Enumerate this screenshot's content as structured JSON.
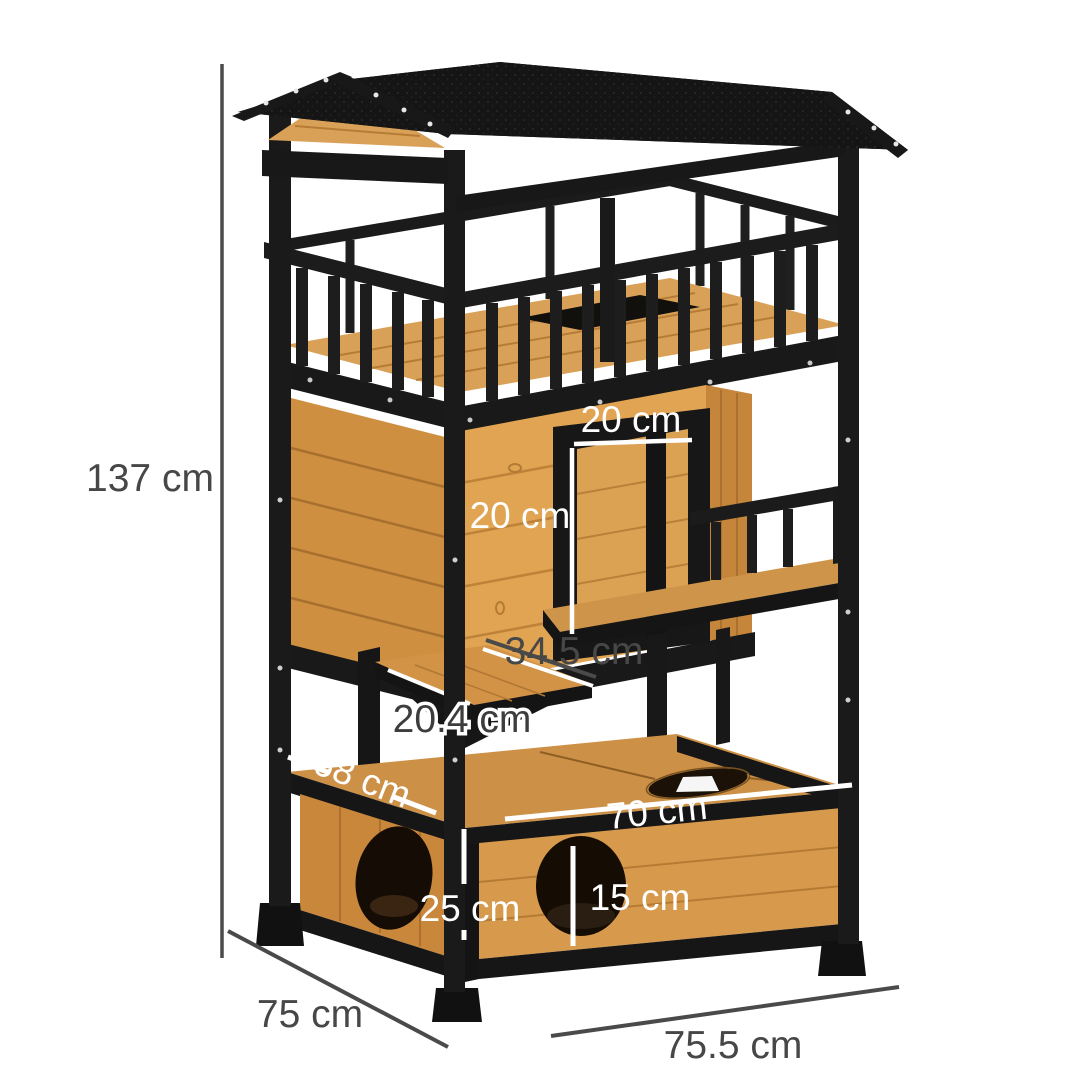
{
  "figure": {
    "type": "product-dimension-diagram"
  },
  "annotations": {
    "total_height": "137 cm",
    "door_width": "20 cm",
    "door_height": "20 cm",
    "shelf_width": "34.5 cm",
    "shelf_depth": "20.4 cm",
    "side_depth": "68 cm",
    "front_width": "70 cm",
    "box_height": "25 cm",
    "hole_diameter": "15 cm",
    "base_depth": "75 cm",
    "base_width": "75.5 cm"
  },
  "colors": {
    "background": "#ffffff",
    "frame_black": "#1a1a1a",
    "roof_black": "#151515",
    "wood_plank": "#e1a452",
    "wood_side": "#c9883c",
    "wood_floor": "#cc9146",
    "dim_dark": "#474747",
    "dim_white": "#ffffff"
  }
}
